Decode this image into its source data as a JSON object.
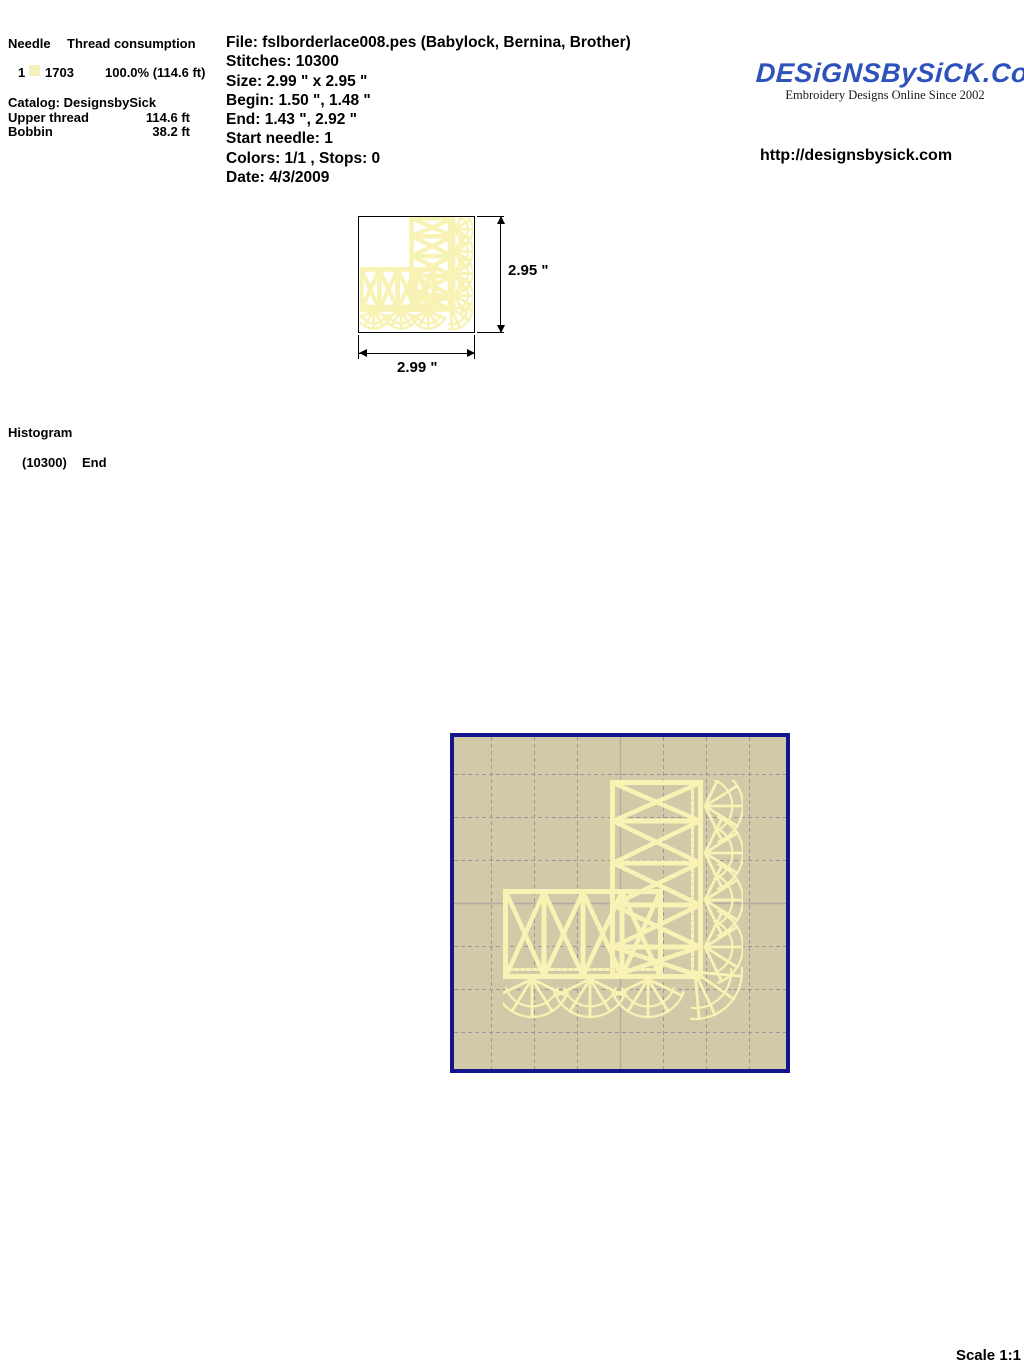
{
  "colors": {
    "logo_blue": "#2e52bc",
    "preview_bg": "#d2c9a8",
    "preview_border": "#14148c",
    "grid_line": "#9a9a9a",
    "center_line": "#b0aea2",
    "design_yellow": "#f8f3b4",
    "swatch_yellow": "#f5f1bd"
  },
  "thread_panel": {
    "header_needle": "Needle",
    "header_consumption": "Thread consumption",
    "needle_number": "1",
    "thread_code": "1703",
    "thread_usage": "100.0% (114.6 ft)",
    "catalog": "Catalog: DesignsbySick",
    "upper_thread_label": "Upper thread",
    "upper_thread_value": "114.6 ft",
    "bobbin_label": "Bobbin",
    "bobbin_value": "38.2 ft"
  },
  "file_info": {
    "file": "File: fslborderlace008.pes  (Babylock, Bernina, Brother)",
    "stitches": "Stitches: 10300",
    "size": "Size: 2.99 \" x 2.95 \"",
    "begin": "Begin: 1.50 \", 1.48 \"",
    "end": "End: 1.43 \", 2.92 \"",
    "start_needle": "Start needle: 1",
    "colors_line": "Colors: 1/1 , Stops: 0",
    "date": "Date: 4/3/2009"
  },
  "brand": {
    "logo_text": "DESiGNSBySiCK.CoM",
    "tagline": "Embroidery Designs Online Since 2002",
    "url": "http://designsbysick.com"
  },
  "dimensions": {
    "height_label": "2.95 \"",
    "width_label": "2.99 \""
  },
  "histogram": {
    "title": "Histogram",
    "entry_count": "(10300)",
    "entry_label": "End"
  },
  "scale_label": "Scale 1:1"
}
